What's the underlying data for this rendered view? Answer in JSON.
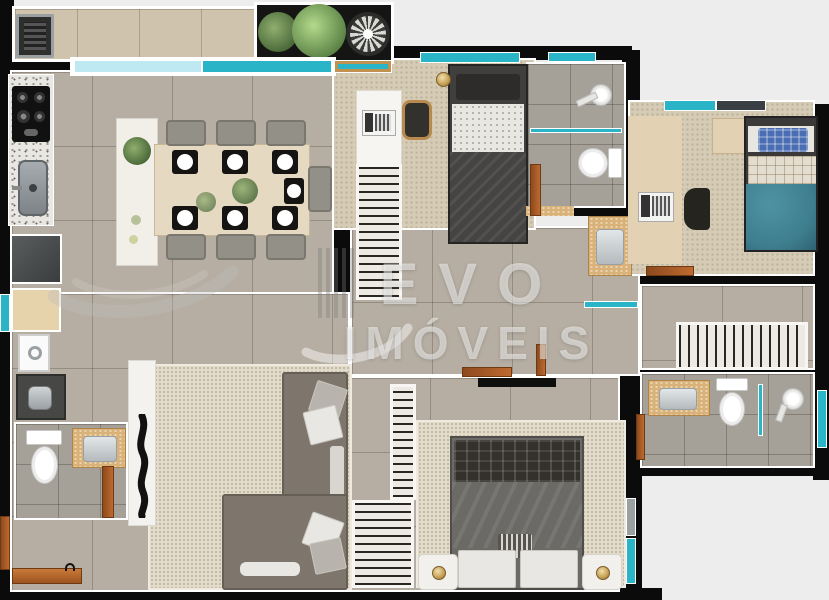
{
  "watermark": {
    "line1": "EVO",
    "line2": "IMÓVEIS"
  },
  "palette": {
    "background": "#ededed",
    "wall": "#0c0b0b",
    "wall_face": "#ffffff",
    "window_teal": "#29b4c8",
    "window_light": "#bfe9f2",
    "door_orange": "#bf6a30",
    "floor_tile": "#b6aea2",
    "bath_tile": "#a5a098",
    "carpet": "#d6ccb6",
    "rug": "#e3dccb",
    "counter_tan": "#d9b279",
    "granite": "#e9e7e3",
    "sofa": "#7e766c",
    "bed_dark": "#413f3d",
    "duvet_gray": "#6b6a67",
    "teal_blanket": "#3e7e8e",
    "pillow_blue": "#4a6db3",
    "gold": "#c9a45a",
    "plant_green": "#6f8f5a",
    "watermark": "rgba(255,255,255,0.5)"
  },
  "legend": {
    "rooms": [
      "balcony-gourmet",
      "kitchen",
      "dining-room",
      "living-room",
      "bedroom-1",
      "bedroom-2",
      "master-bedroom",
      "bathroom-1",
      "bathroom-2",
      "bathroom-3",
      "laundry",
      "closet",
      "hall"
    ],
    "fixtures": [
      "bbq-grill",
      "cooktop",
      "kitchen-sink",
      "refrigerator",
      "washing-machine",
      "laundry-sink",
      "dining-table",
      "dining-chairs",
      "sideboard",
      "sofa",
      "tv",
      "tv-console",
      "single-bed",
      "double-bed",
      "desk",
      "laptop",
      "wardrobe-hangers",
      "toilet",
      "shower",
      "vanity-sink",
      "nightstand",
      "lamp",
      "plants",
      "ceiling-fan",
      "windows",
      "doors"
    ]
  }
}
